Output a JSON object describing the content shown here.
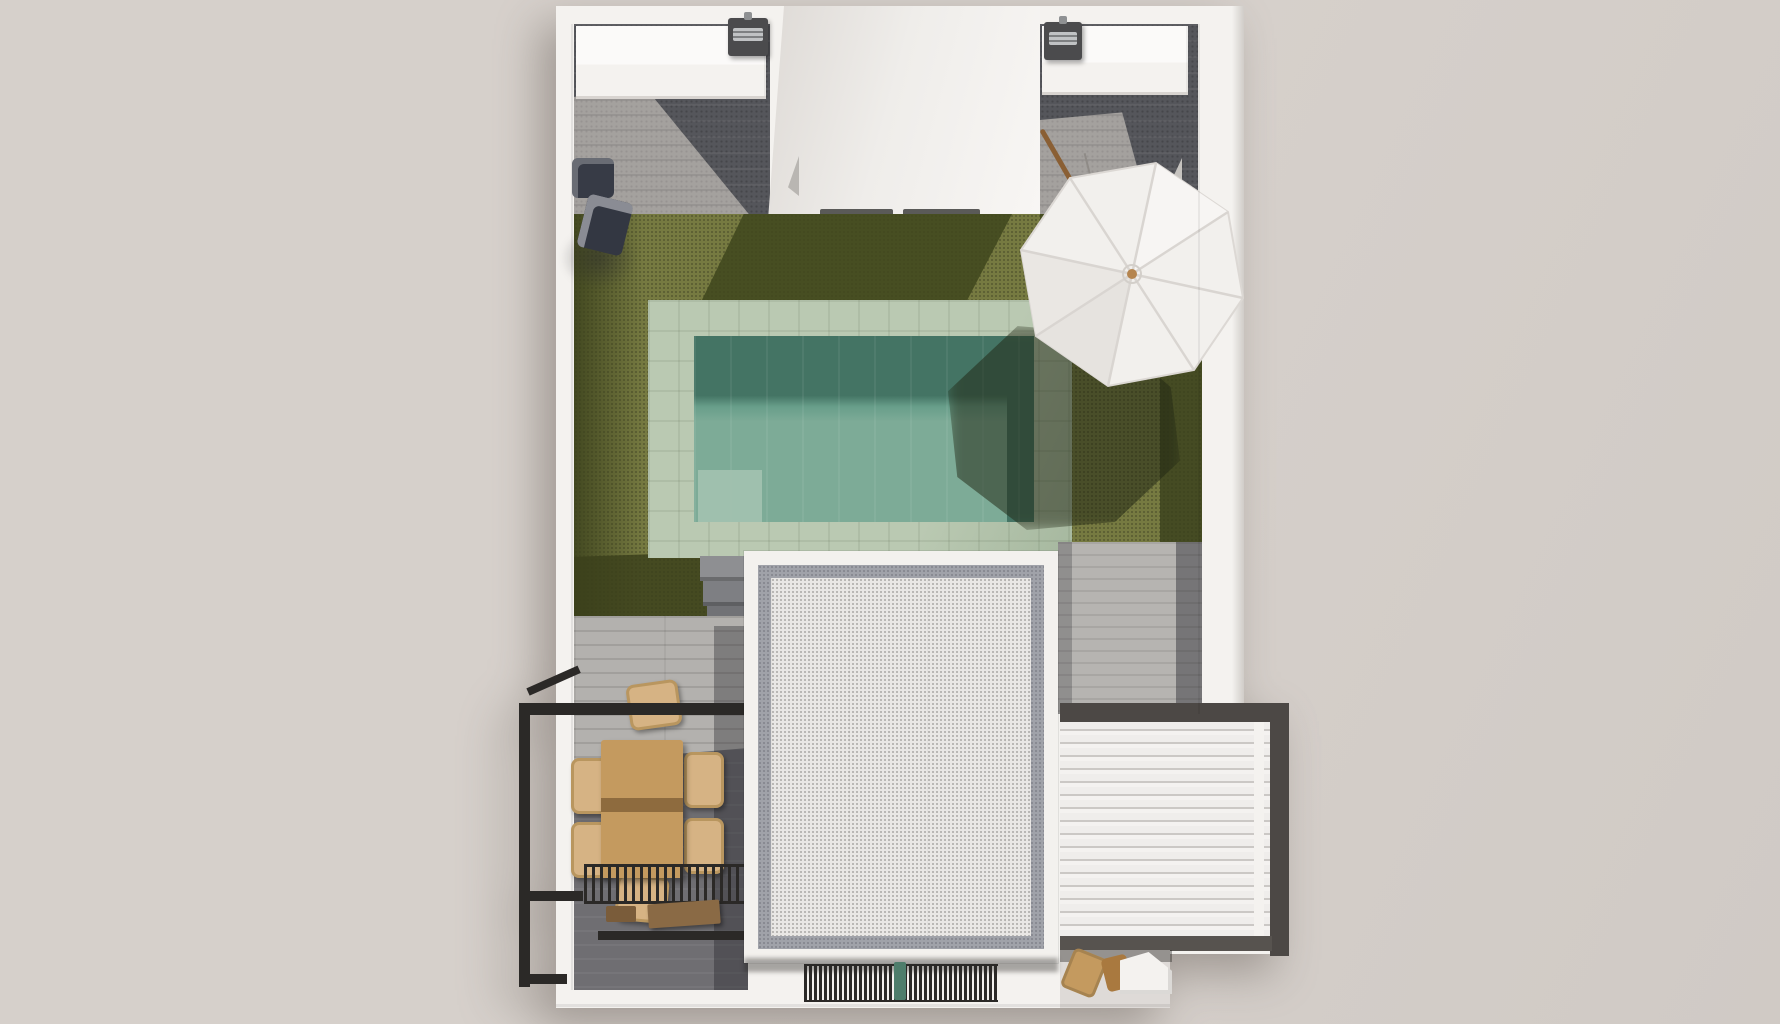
{
  "scene": {
    "type": "architectural-3d-top-view-render",
    "description_labels": {
      "property": "villa-rooftop-terrace-plan",
      "pool": "tiled-swimming-pool",
      "lawn": "artificial-grass-lawn",
      "umbrella": "white-parasol",
      "building": "white-gravel-roof-volume",
      "louver": "white-louvered-pergola-roof",
      "pergola": "black-steel-pergola-frame",
      "dining": "wooden-dining-table-with-rattan-chairs",
      "kitchens": "two-outdoor-kitchen-counters-with-bbq-grills",
      "stairs": "concrete-steps-to-lower-terrace"
    },
    "text_content": []
  },
  "palette": {
    "bg": "#d6d0cb",
    "bg_dark": "#d0cac5",
    "wall": "#f4f2ef",
    "wall_shade": "#dedad6",
    "floor_dark": "#55565b",
    "floor_light": "#a4a19e",
    "stone": "#b3b1ae",
    "grass": "#767a41",
    "grass_shadow": "#41481e",
    "coping": "#bac9b2",
    "coping_shade": "#a6b89f",
    "water": "#7dab97",
    "water_dark": "#447464",
    "water_step": "#a3c2b0",
    "roof_border": "#f3f1ee",
    "roof_frame": "#a0a2a9",
    "roof_gravel": "#e9e7e5",
    "louver_light": "#efedeb",
    "louver_shade": "#cbc8c5",
    "frame_dark": "#4c4845",
    "pergola_black": "#2b2927",
    "deck": "#b6b4b1",
    "deck_dark": "#6f6e72",
    "table_wood": "#c49a5f",
    "table_shadow": "#8e6b3e",
    "chair_rattan": "#d6b384",
    "bench_wood": "#8a6a45",
    "grill_dark": "#4b4b4d",
    "grill_metal": "#c0c2c4",
    "umbrella": "#f2f0ed",
    "umbrella_seam": "#d9d5d1",
    "umbrella_hub": "#b5854f",
    "pipe_green": "#4e7d6b",
    "object_navy": "#373b46",
    "pole_wood": "#8a5f34"
  }
}
